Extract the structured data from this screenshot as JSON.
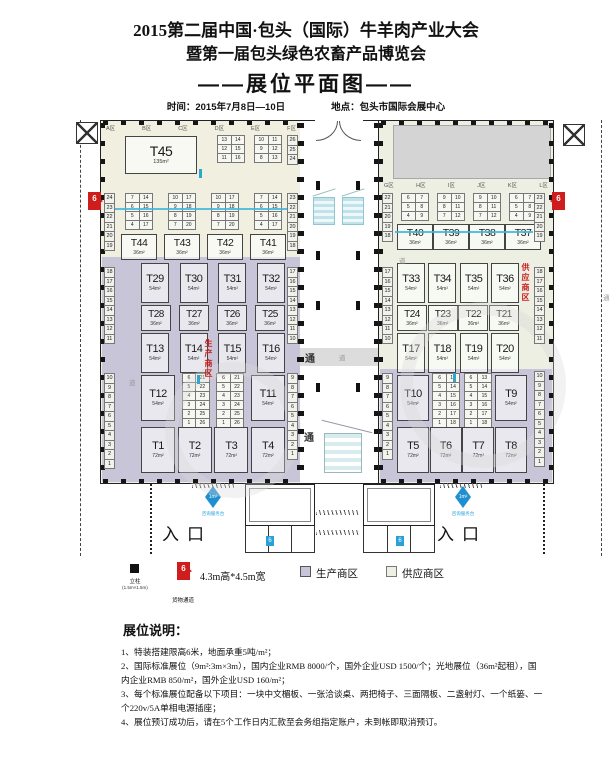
{
  "header": {
    "title1": "2015第二届中国·包头（国际）牛羊肉产业大会",
    "title2": "暨第一届包头绿色农畜产品博览会",
    "plan_title": "——展位平面图——",
    "time_label": "时间：2015年7月8日—10日",
    "venue_label": "地点：包头市国际会展中心"
  },
  "plan": {
    "corridor_tong": "通",
    "corridor_dao": "道",
    "entrance_label": "入口",
    "prod_zone_label": "生产商区",
    "supply_zone_label": "供应商区",
    "cargo_num": "6",
    "blue_num": "6",
    "diamond_label": "1m²",
    "diamond_sub": "咨询服务台"
  },
  "left_hall": {
    "zones": [
      "A区",
      "B区",
      "C区",
      "D区",
      "E区",
      "F区"
    ],
    "t45": {
      "n": "T45",
      "a": "135m²"
    },
    "grid_d": [
      [
        "13",
        "14"
      ],
      [
        "12",
        "15"
      ],
      [
        "11",
        "16"
      ]
    ],
    "grid_e": [
      [
        "10",
        "11"
      ],
      [
        "9",
        "12"
      ],
      [
        "8",
        "13"
      ]
    ],
    "col_f": [
      "26",
      "25",
      "24"
    ],
    "row2": {
      "grids": [
        [
          [
            "7",
            "14"
          ],
          [
            "6",
            "15"
          ],
          [
            "5",
            "16"
          ],
          [
            "4",
            "17"
          ]
        ],
        [
          [
            "10",
            "17"
          ],
          [
            "9",
            "18"
          ],
          [
            "8",
            "19"
          ],
          [
            "7",
            "20"
          ]
        ],
        [
          [
            "10",
            "17"
          ],
          [
            "9",
            "18"
          ],
          [
            "8",
            "19"
          ],
          [
            "7",
            "20"
          ]
        ],
        [
          [
            "7",
            "14"
          ],
          [
            "6",
            "15"
          ],
          [
            "5",
            "16"
          ],
          [
            "4",
            "17"
          ]
        ]
      ],
      "booths": [
        {
          "n": "T44",
          "a": "36m²"
        },
        {
          "n": "T43",
          "a": "36m²"
        },
        {
          "n": "T42",
          "a": "36m²"
        },
        {
          "n": "T41",
          "a": "36m²"
        }
      ]
    },
    "prod1": [
      {
        "n": "T29",
        "a": "54m²"
      },
      {
        "n": "T30",
        "a": "54m²"
      },
      {
        "n": "T31",
        "a": "54m²"
      },
      {
        "n": "T32",
        "a": "54m²"
      }
    ],
    "prod2": [
      {
        "n": "T28",
        "a": "36m²"
      },
      {
        "n": "T27",
        "a": "36m²"
      },
      {
        "n": "T26",
        "a": "36m²"
      },
      {
        "n": "T25",
        "a": "36m²"
      }
    ],
    "prod3": [
      {
        "n": "T13",
        "a": "54m²"
      },
      {
        "n": "T14",
        "a": "54m²"
      },
      {
        "n": "T15",
        "a": "54m²"
      },
      {
        "n": "T16",
        "a": "54m²"
      }
    ],
    "lower": {
      "b_left": {
        "n": "T12",
        "a": "54m²"
      },
      "grid1": [
        [
          "6",
          "21"
        ],
        [
          "5",
          "22"
        ],
        [
          "4",
          "23"
        ],
        [
          "3",
          "24"
        ],
        [
          "2",
          "25"
        ],
        [
          "1",
          "26"
        ]
      ],
      "grid2": [
        [
          "6",
          "21"
        ],
        [
          "5",
          "22"
        ],
        [
          "4",
          "23"
        ],
        [
          "3",
          "24"
        ],
        [
          "2",
          "25"
        ],
        [
          "1",
          "26"
        ]
      ],
      "b_right": {
        "n": "T11",
        "a": "54m²"
      }
    },
    "bottom": [
      {
        "n": "T1",
        "a": "72m²"
      },
      {
        "n": "T2",
        "a": "72m²"
      },
      {
        "n": "T3",
        "a": "72m²"
      },
      {
        "n": "T4",
        "a": "72m²"
      }
    ],
    "strips": {
      "l_top": [
        "24",
        "23",
        "22",
        "21",
        "20",
        "19"
      ],
      "l_mid": [
        "18",
        "17",
        "16",
        "15",
        "14",
        "13",
        "12",
        "11"
      ],
      "l_bot": [
        "10",
        "9",
        "8",
        "7",
        "6",
        "5",
        "4",
        "3",
        "2",
        "1"
      ],
      "r_top": [
        "23",
        "22",
        "21",
        "20",
        "19",
        "18"
      ],
      "r_mid": [
        "17",
        "16",
        "15",
        "14",
        "13",
        "12",
        "11",
        "10"
      ],
      "r_bot": [
        "9",
        "8",
        "7",
        "6",
        "5",
        "4",
        "3",
        "2",
        "1"
      ]
    }
  },
  "right_hall": {
    "zones": [
      "G区",
      "H区",
      "I区",
      "J区",
      "K区",
      "L区"
    ],
    "row2": {
      "grids": [
        [
          [
            "6",
            "7"
          ],
          [
            "5",
            "8"
          ],
          [
            "4",
            "9"
          ]
        ],
        [
          [
            "9",
            "10"
          ],
          [
            "8",
            "11"
          ],
          [
            "7",
            "12"
          ]
        ],
        [
          [
            "9",
            "10"
          ],
          [
            "8",
            "11"
          ],
          [
            "7",
            "12"
          ]
        ],
        [
          [
            "6",
            "7"
          ],
          [
            "5",
            "8"
          ],
          [
            "4",
            "9"
          ]
        ]
      ],
      "booths": [
        {
          "n": "T40",
          "a": "36m²"
        },
        {
          "n": "T39",
          "a": "36m²"
        },
        {
          "n": "T38",
          "a": "36m²"
        },
        {
          "n": "T37",
          "a": "36m²"
        }
      ]
    },
    "sup1": [
      {
        "n": "T33",
        "a": "54m²"
      },
      {
        "n": "T34",
        "a": "54m²"
      },
      {
        "n": "T35",
        "a": "54m²"
      },
      {
        "n": "T36",
        "a": "54m²"
      }
    ],
    "sup2": [
      {
        "n": "T24",
        "a": "36m²"
      },
      {
        "n": "T23",
        "a": "36m²"
      },
      {
        "n": "T22",
        "a": "36m²"
      },
      {
        "n": "T21",
        "a": "36m²"
      }
    ],
    "sup3": [
      {
        "n": "T17",
        "a": "54m²"
      },
      {
        "n": "T18",
        "a": "54m²"
      },
      {
        "n": "T19",
        "a": "54m²"
      },
      {
        "n": "T20",
        "a": "54m²"
      }
    ],
    "lower": {
      "b_left": {
        "n": "T10",
        "a": "54m²"
      },
      "grid1": [
        [
          "6",
          "13"
        ],
        [
          "5",
          "14"
        ],
        [
          "4",
          "15"
        ],
        [
          "3",
          "16"
        ],
        [
          "2",
          "17"
        ],
        [
          "1",
          "18"
        ]
      ],
      "grid2": [
        [
          "6",
          "13"
        ],
        [
          "5",
          "14"
        ],
        [
          "4",
          "15"
        ],
        [
          "3",
          "16"
        ],
        [
          "2",
          "17"
        ],
        [
          "1",
          "18"
        ]
      ],
      "b_right": {
        "n": "T9",
        "a": "54m²"
      }
    },
    "bottom": [
      {
        "n": "T5",
        "a": "72m²"
      },
      {
        "n": "T6",
        "a": "72m²"
      },
      {
        "n": "T7",
        "a": "72m²"
      },
      {
        "n": "T8",
        "a": "72m²"
      }
    ],
    "strips": {
      "l_top": [
        "22",
        "21",
        "20",
        "19",
        "18"
      ],
      "l_mid": [
        "17",
        "16",
        "15",
        "14",
        "13",
        "12",
        "11",
        "10"
      ],
      "l_bot": [
        "9",
        "8",
        "7",
        "6",
        "5",
        "4",
        "3",
        "2",
        "1"
      ],
      "r_top": [
        "23",
        "22",
        "21",
        "20",
        "19"
      ],
      "r_mid": [
        "18",
        "17",
        "16",
        "15",
        "14",
        "13",
        "12",
        "11"
      ],
      "r_bot": [
        "10",
        "9",
        "8",
        "7",
        "6",
        "5",
        "4",
        "3",
        "2",
        "1"
      ]
    }
  },
  "legend": {
    "pillar_label": "立柱",
    "pillar_size": "(1.5m×1.5m)",
    "cargo_num": "6",
    "cargo_size": "4.3m高*4.5m宽",
    "cargo_label": "货物通道",
    "prod_label": "生产商区",
    "supply_label": "供应商区"
  },
  "notes": {
    "title": "展位说明：",
    "items": [
      "1、特装搭建限高6米，地面承重5吨/m²；",
      "2、国际标准展位（9m²:3m×3m），国内企业RMB 8000/个，国外企业USD 1500/个；光地展位（36m²起租），国内企业RMB 850/m²，国外企业USD 160/m²；",
      "3、每个标准展位配备以下项目：一块中文楣板、一张洽谈桌、两把椅子、三面隔板、二盏射灯、一个纸篓、一个220v/5A单相电源插座；",
      "4、展位预订成功后，请在5个工作日内汇款至会务组指定账户，未到帐即取消预订。"
    ]
  }
}
